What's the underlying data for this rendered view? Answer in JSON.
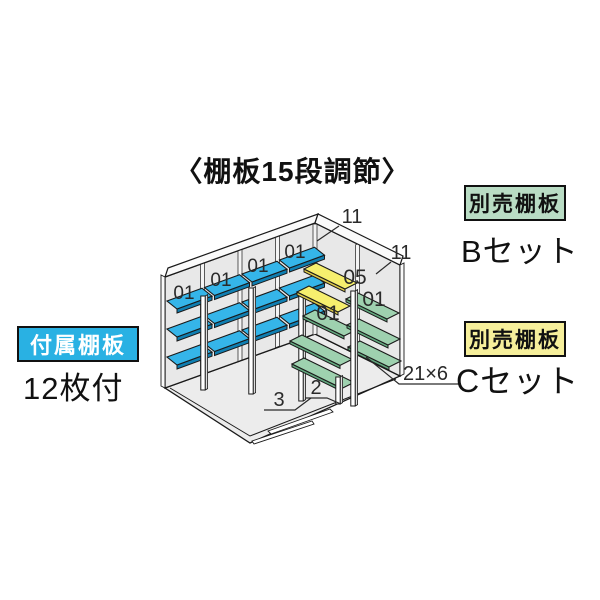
{
  "title": "〈棚板15段調節〉",
  "colors": {
    "ink": "#1a1a1a",
    "part_text": "#2a2a2a",
    "shelf_blue": "#35b5e9",
    "shelf_blue_edge": "#0f7fb2",
    "shelf_yellow": "#f6ef6e",
    "shelf_yellow_edge": "#ddc94a",
    "shelf_green": "#9ed1af",
    "shelf_green_edge": "#63a87f",
    "wall": "#e8e8e8",
    "wall_strip": "#fafafa",
    "wall_division": "#f4f4f4",
    "floor": "#ececec",
    "post_face": "#ffffff",
    "post_side": "#dedede",
    "tag_included_bg": "#29b1e3",
    "tag_b_bg": "#b9dcc4",
    "tag_c_bg": "#f6ef9b"
  },
  "legend": {
    "included": {
      "tag": "付属棚板",
      "caption": "12枚付"
    },
    "set_b": {
      "tag": "別売棚板",
      "caption": "Bセット"
    },
    "set_c": {
      "tag": "別売棚板",
      "caption": "Cセット"
    }
  },
  "diagram": {
    "wall_top_back_label": "11",
    "wall_top_side_label": "11",
    "blue_labels": [
      "01",
      "01",
      "01",
      "01"
    ],
    "yellow_label": "05",
    "green_label_near": "01",
    "green_label_far": "01",
    "tall_post_label": "3",
    "short_post_label": "2",
    "green_qty_label": "21×6"
  }
}
